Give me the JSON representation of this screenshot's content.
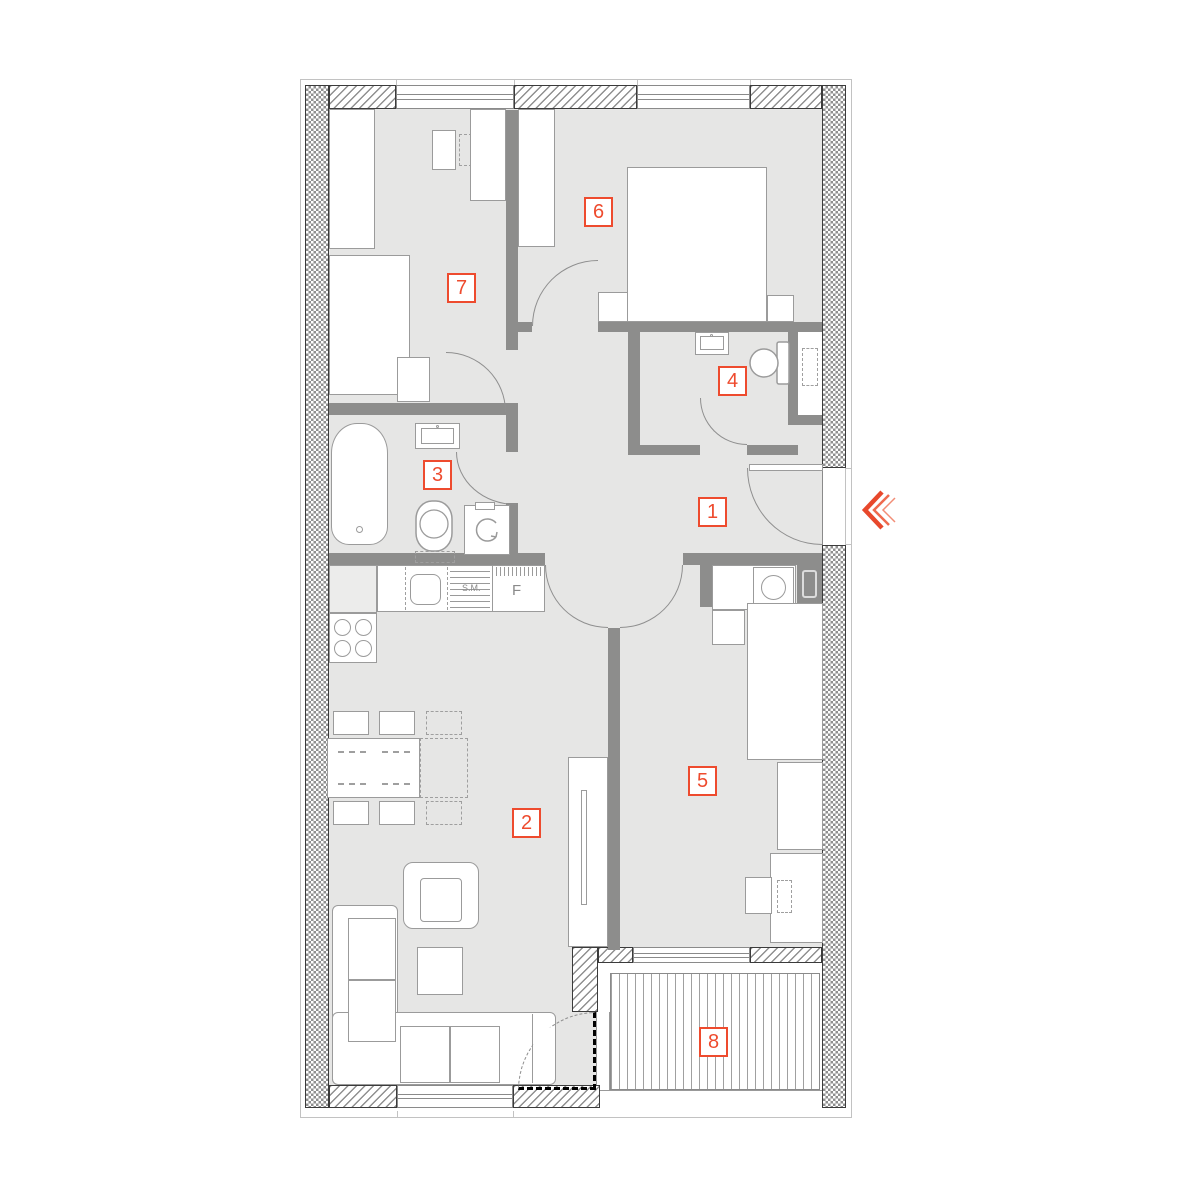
{
  "colors": {
    "accent": "#ee4b2e",
    "floor": "#e6e6e5",
    "wall": "#8d8d8c"
  },
  "rooms": [
    {
      "label": "1"
    },
    {
      "label": "2"
    },
    {
      "label": "3"
    },
    {
      "label": "4"
    },
    {
      "label": "5"
    },
    {
      "label": "6"
    },
    {
      "label": "7"
    },
    {
      "label": "8"
    }
  ],
  "kitchen": {
    "dishwasher_label": "S.M.",
    "fridge_label": "F"
  }
}
